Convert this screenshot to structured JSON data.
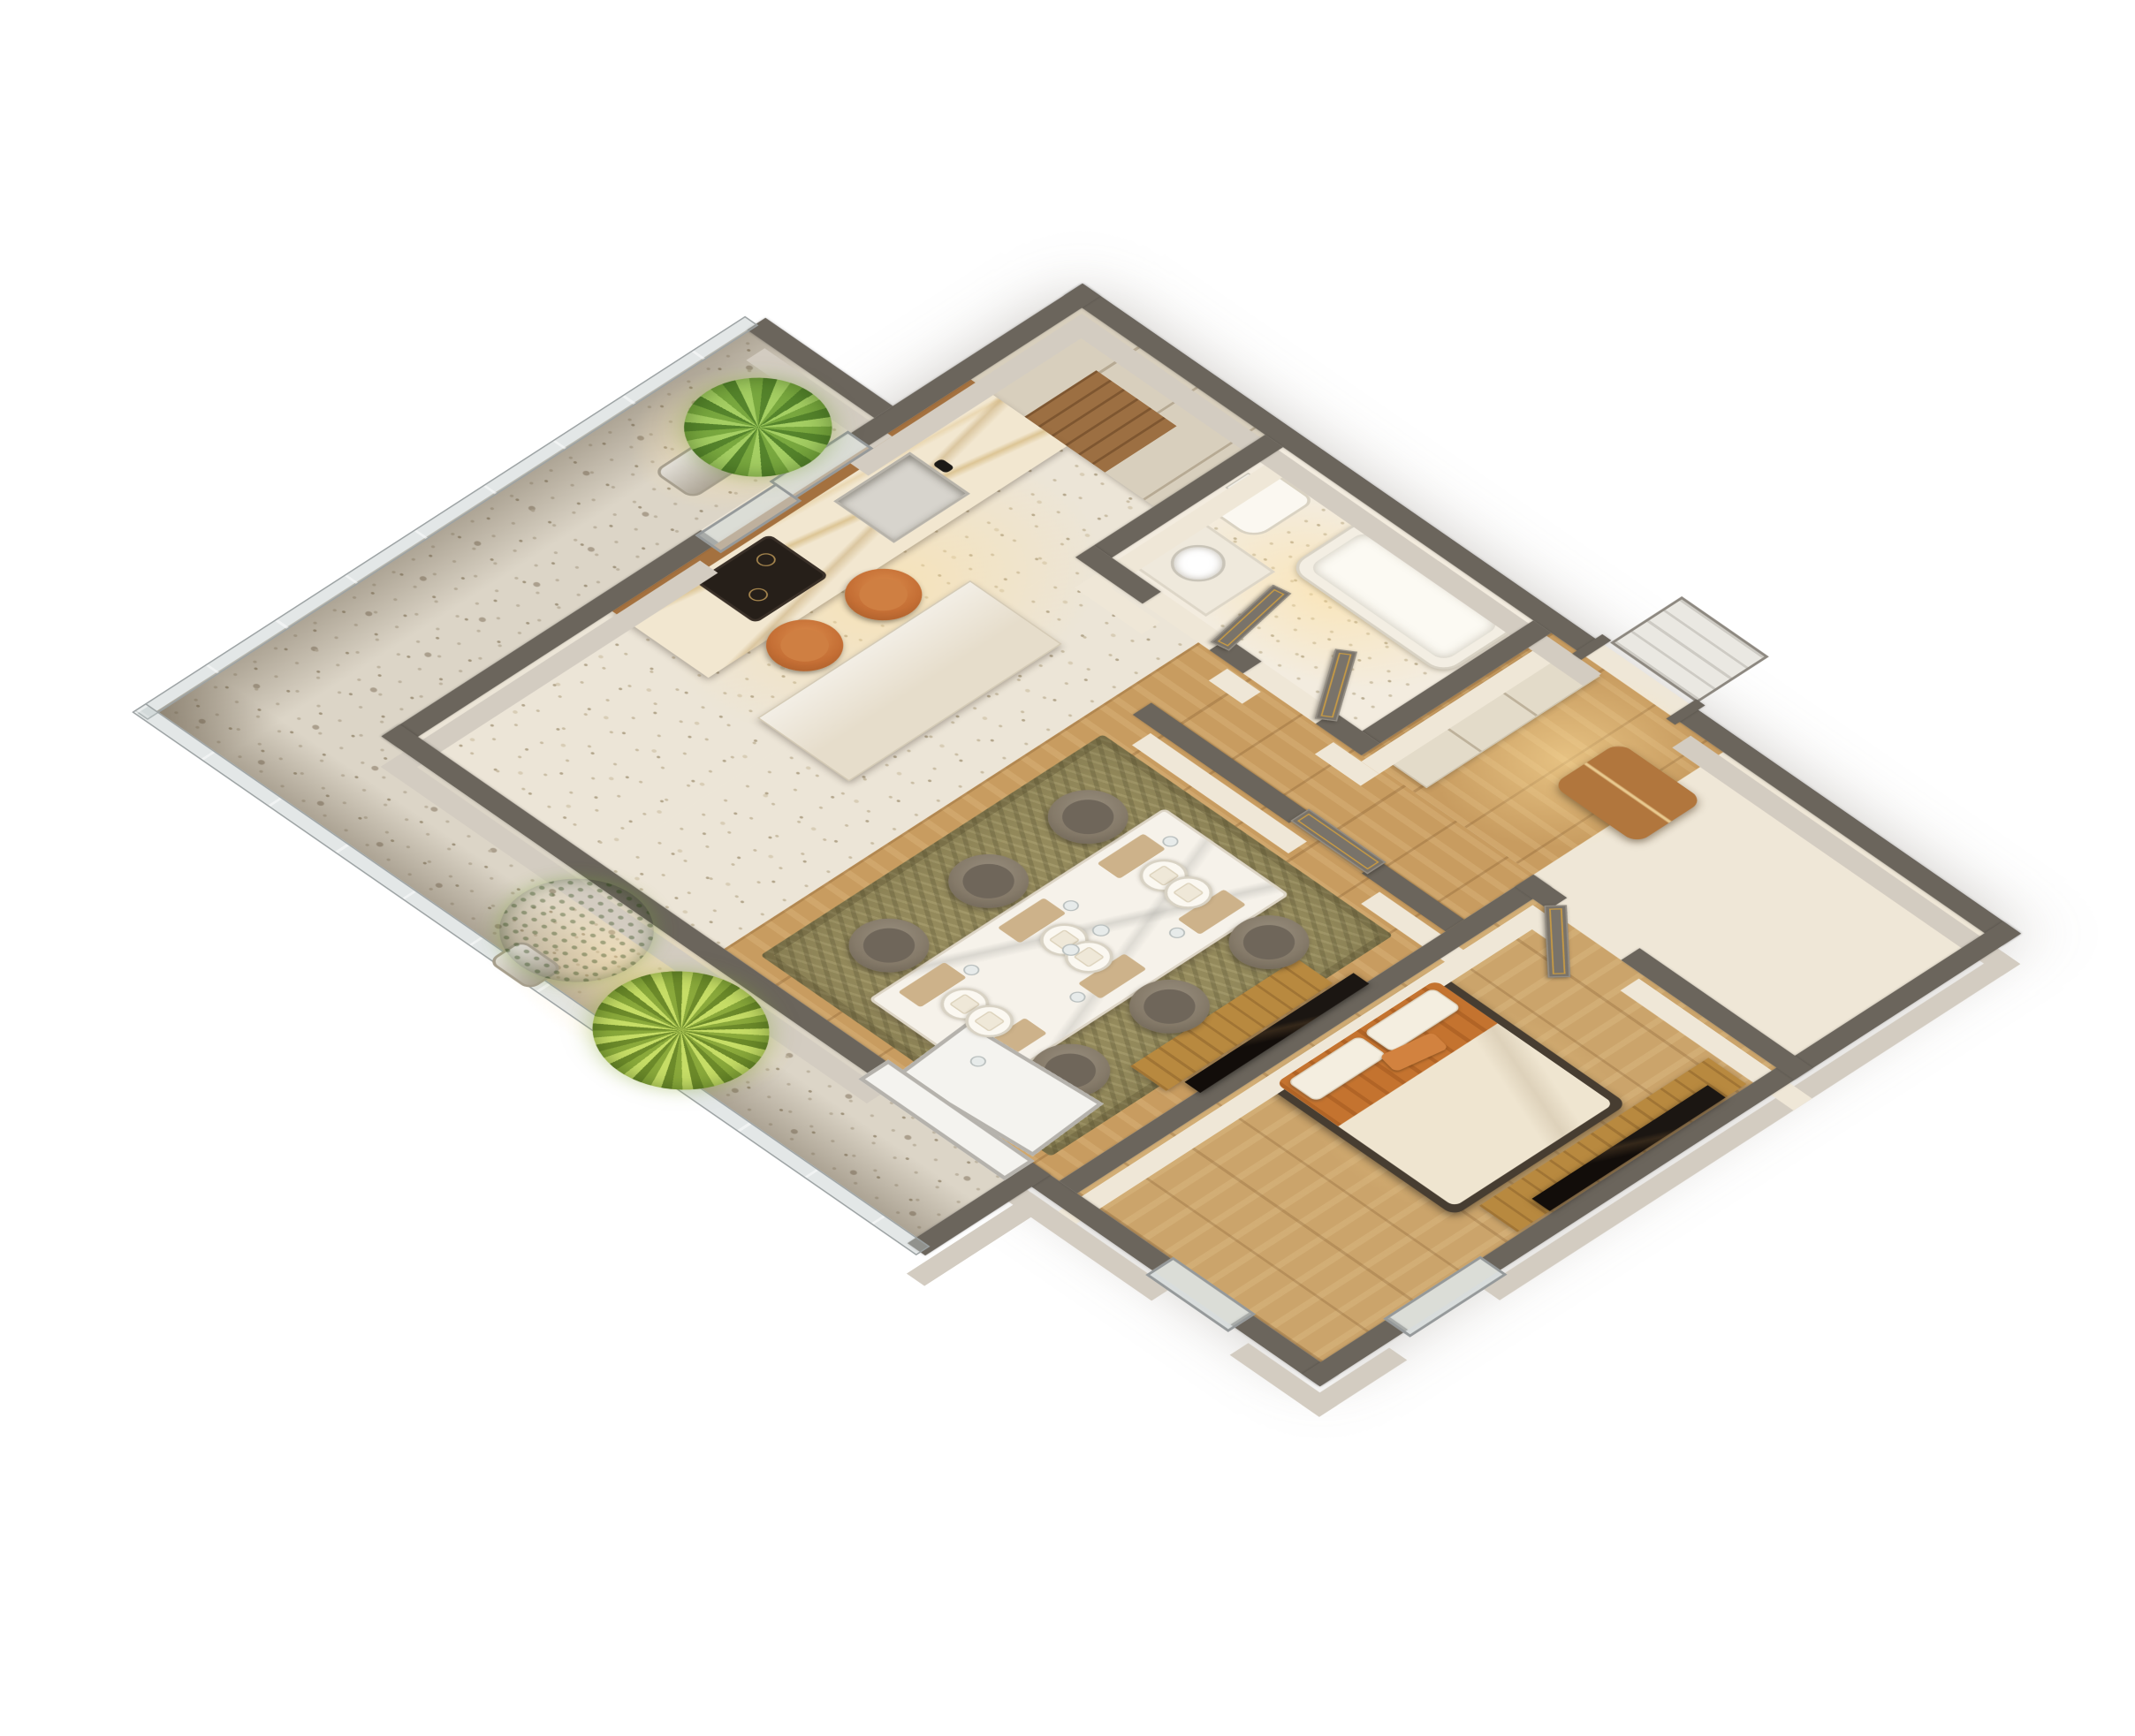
{
  "scene": {
    "type": "isometric-3d-floor-plan",
    "subject": "Photoreal 3D isometric floor plan of a one-bedroom apartment with wrap-around balcony",
    "rooms": [
      {
        "id": "kitchen",
        "label": "kitchen"
      },
      {
        "id": "bathroom",
        "label": "bathroom"
      },
      {
        "id": "entry-hall",
        "label": "entry hall"
      },
      {
        "id": "hallway",
        "label": "hallway"
      },
      {
        "id": "living-dining",
        "label": "living-dining room"
      },
      {
        "id": "bedroom",
        "label": "bedroom"
      },
      {
        "id": "balcony",
        "label": "balcony"
      }
    ],
    "furniture_inventory": {
      "dining_chairs": 6,
      "place_settings": 6,
      "kitchen_counter_chairs": 2,
      "beds": 1,
      "tvs": 2,
      "potted_plants": 3,
      "interior_doors": 4,
      "entrance_doors": 1,
      "bathtubs": 1,
      "toilets": 1,
      "kitchen_sinks": 1,
      "ottomans": 1,
      "wall_consoles": 2
    }
  },
  "palette": {
    "bg": "#ffffff",
    "wallTop": "#6b655c",
    "wallFaceExt": "#d3ccc1",
    "wallFaceInt": "#efe7d7",
    "woodFloor": "#c89c60",
    "terrazzo": "#ece5d7",
    "balconyFloor": "#dcd5c7",
    "rug": "#948a5c",
    "marble": "#f2e7d0",
    "cabinet": "#d8cfbd",
    "doorDark": "#79736a",
    "doorGold": "#c79a44",
    "tvBlack": "#15100c",
    "woodFurniture": "#b8893f",
    "bedOrange": "#c4732f",
    "pillowOrange": "#d2823f",
    "duvet": "#efe5d0",
    "chairTaupe": "#857a69",
    "chairOrange": "#c56f35",
    "leather": "#b1763d",
    "glass": "#cdd6d6",
    "frameGray": "#95999a",
    "plantGreen": "#79a83f",
    "plantLight": "#b9d45e",
    "white": "#f4f3ef"
  }
}
